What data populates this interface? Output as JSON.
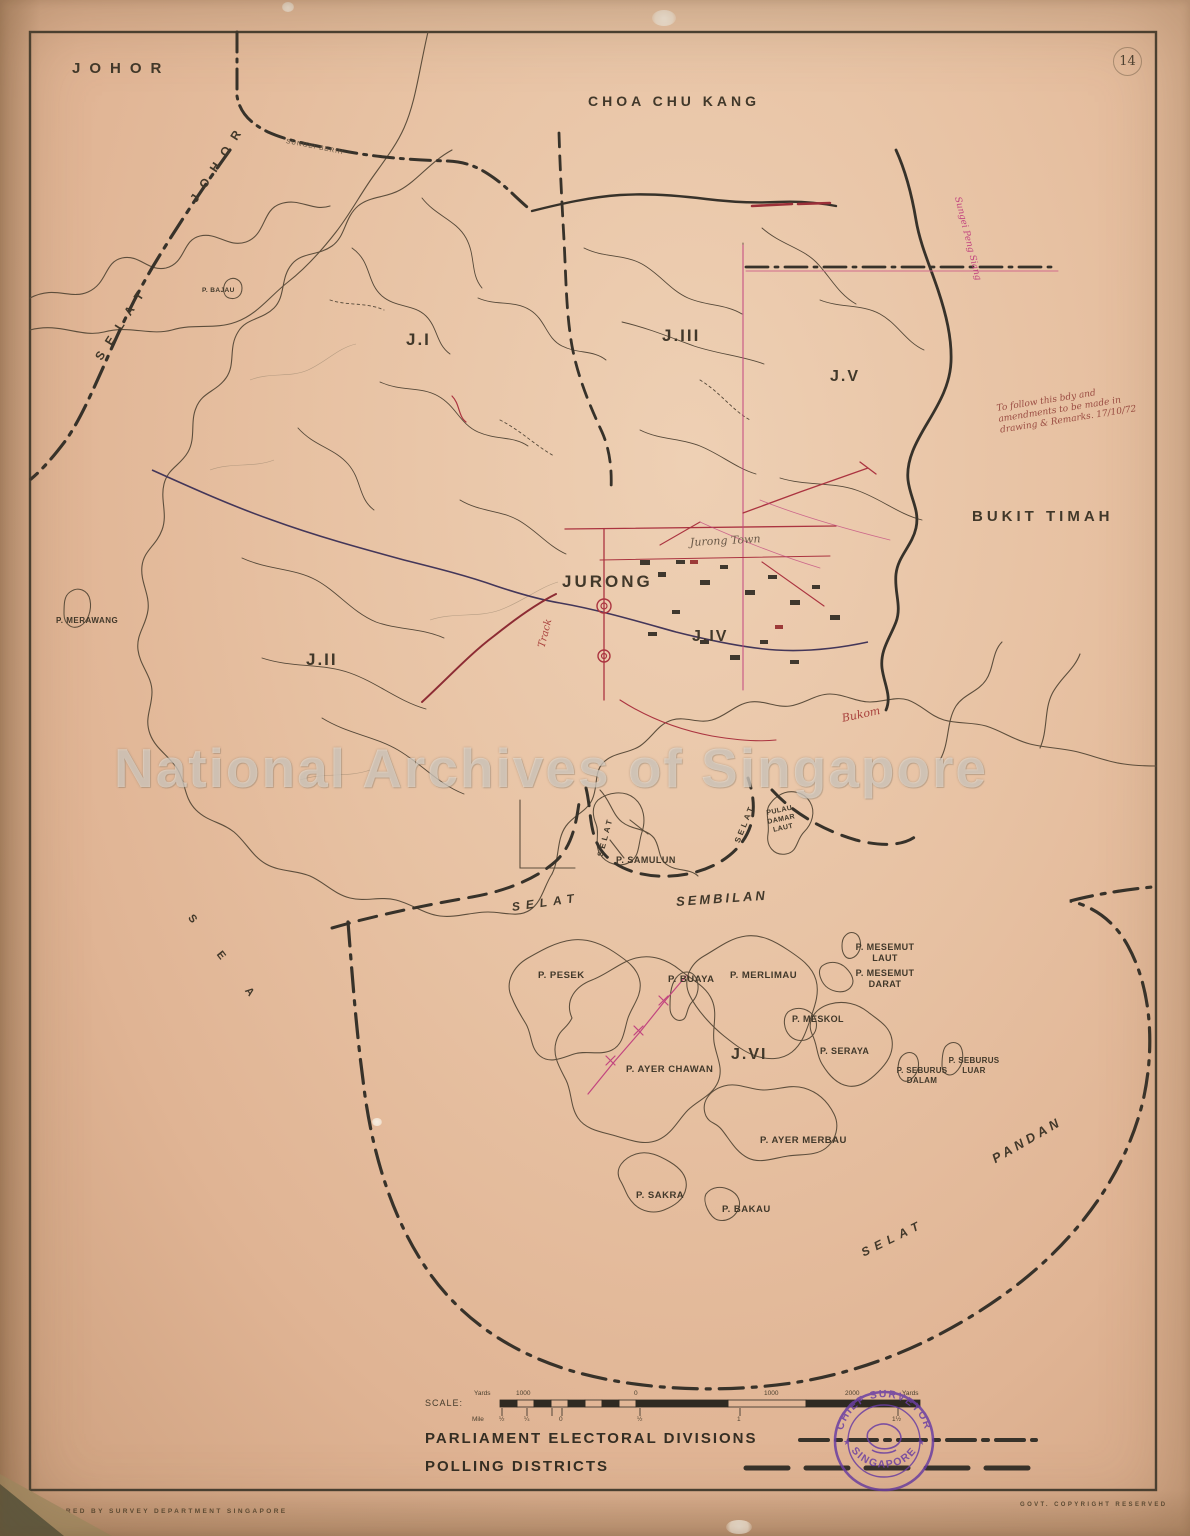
{
  "sheet": {
    "number": "14"
  },
  "watermark": "National Archives of Singapore",
  "regions": {
    "johor": "JOHOR",
    "choa_chu_kang": "CHOA  CHU  KANG",
    "bukit_timah": "BUKIT  TIMAH",
    "jurong": "JURONG",
    "sea": "S E A"
  },
  "straits": {
    "selat_johor": {
      "selat": "SELAT",
      "johor": "JOHOR"
    },
    "selat_sembilan": {
      "selat": "SELAT",
      "sembilan": "SEMBILAN"
    },
    "selat_pandan": {
      "selat": "SELAT",
      "pandan": "PANDAN"
    },
    "selat_samulun": "SELAT",
    "selat_damar": "SELAT"
  },
  "districts": {
    "j1": "J.I",
    "j2": "J.II",
    "j3": "J.III",
    "j4": "J.IV",
    "j5": "J.V",
    "j6": "J.VI"
  },
  "islands": {
    "merawang": "P. MERAWANG",
    "bajau": "P. BAJAU",
    "samulun": "P. SAMULUN",
    "damar_laut": "PULAU DAMAR LAUT",
    "pesek": "P. PESEK",
    "buaya": "P. BUAYA",
    "merlimau": "P. MERLIMAU",
    "mesemut_laut": "P. MESEMUT LAUT",
    "mesemut_darat": "P. MESEMUT DARAT",
    "meskol": "P. MESKOL",
    "seraya": "P. SERAYA",
    "seburus_dalam": "P. SEBURUS DALAM",
    "seburus_luar": "P. SEBURUS LUAR",
    "ayer_chawan": "P. AYER CHAWAN",
    "ayer_merbau": "P. AYER MERBAU",
    "sakra": "P. SAKRA",
    "bakau": "P. BAKAU"
  },
  "annotations": {
    "sungei_berih": "SUNGEI BERIH",
    "sungei_peng_siang": "Sungei Peng Siang",
    "jurong_town": "Jurong   Town",
    "track": "Track",
    "bukom": "Bukom",
    "note": "To follow this bdy and amendments to be made in drawing & Remarks. 17/10/72"
  },
  "legend": {
    "scale_label": "SCALE:",
    "yards_ticks": [
      "Yards",
      "1000",
      "0",
      "1000",
      "2000",
      "Yards"
    ],
    "mile_ticks": [
      "Mile",
      "½",
      "¼",
      "0",
      "½",
      "1",
      "1½"
    ],
    "parliament_label": "PARLIAMENT  ELECTORAL  DIVISIONS",
    "polling_label": "POLLING  DISTRICTS"
  },
  "stamp": {
    "arc_top": "CHIEF  SURVEYOR",
    "arc_bottom": "SINGAPORE"
  },
  "footer": {
    "left": "PREPARED  BY  SURVEY  DEPARTMENT  SINGAPORE",
    "right": "GOVT.  COPYRIGHT  RESERVED"
  },
  "colors": {
    "paper": "#e7c1a2",
    "ink": "#4a4034",
    "boundary": "#37322a",
    "red_overlay": "#ab3440",
    "magenta": "#c2457f",
    "stamp_purple": "#6b3fa3"
  }
}
